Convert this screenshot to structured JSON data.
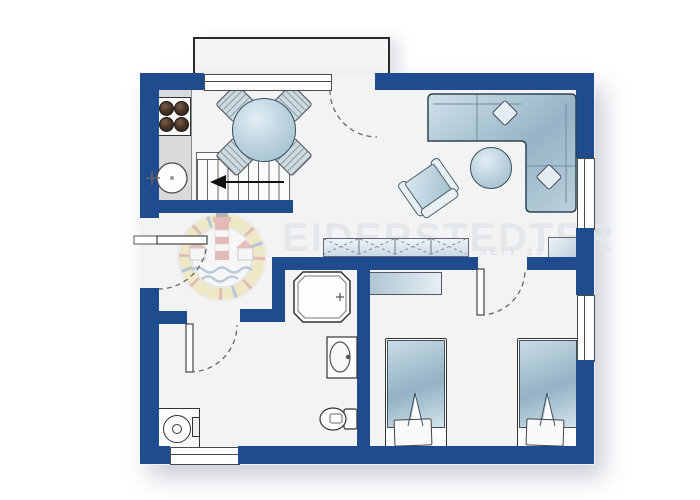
{
  "watermark": {
    "title": "EIDERSTEDTER",
    "subtitle": "SEIT 19",
    "logo": "lighthouse-badge"
  },
  "palette": {
    "wall_blue": "#1e4c8f",
    "floor": "#f3f3f4",
    "furniture_fill_light": "#d9e8f0",
    "furniture_fill_dark": "#9cb9ca",
    "outline": "#333333",
    "counter_gray": "#d9dadb",
    "burner_brown": "#3d2e24",
    "watermark_gray": "#e4e7ea",
    "logo_yellow": "#e8d26a",
    "logo_red": "#bf4a3f",
    "logo_blue": "#3f6fa5"
  },
  "floorplan": {
    "type": "apartment-floor-plan",
    "rooms": [
      {
        "name": "kitchen-dining",
        "furniture": [
          "stove-4-burners",
          "kitchen-counter",
          "kitchen-sink",
          "round-dining-table",
          "dining-chair",
          "dining-chair",
          "dining-chair",
          "dining-chair",
          "staircase-with-arrow"
        ]
      },
      {
        "name": "living-room",
        "furniture": [
          "corner-sofa",
          "sofa-pillow",
          "sofa-pillow",
          "round-coffee-table",
          "armchair",
          "sideboard-4-doors",
          "tv-board"
        ]
      },
      {
        "name": "hallway",
        "furniture": []
      },
      {
        "name": "bathroom",
        "furniture": [
          "corner-shower",
          "washbasin",
          "toilet",
          "washing-machine"
        ]
      },
      {
        "name": "bedroom",
        "furniture": [
          "single-bed",
          "single-bed",
          "wardrobe"
        ]
      },
      {
        "name": "terrace",
        "furniture": []
      }
    ],
    "openings": [
      "entrance-door-left",
      "terrace-door-top",
      "bathroom-door",
      "bedroom-door",
      "window-top",
      "window-right-living",
      "window-right-bedroom",
      "window-bottom"
    ]
  }
}
